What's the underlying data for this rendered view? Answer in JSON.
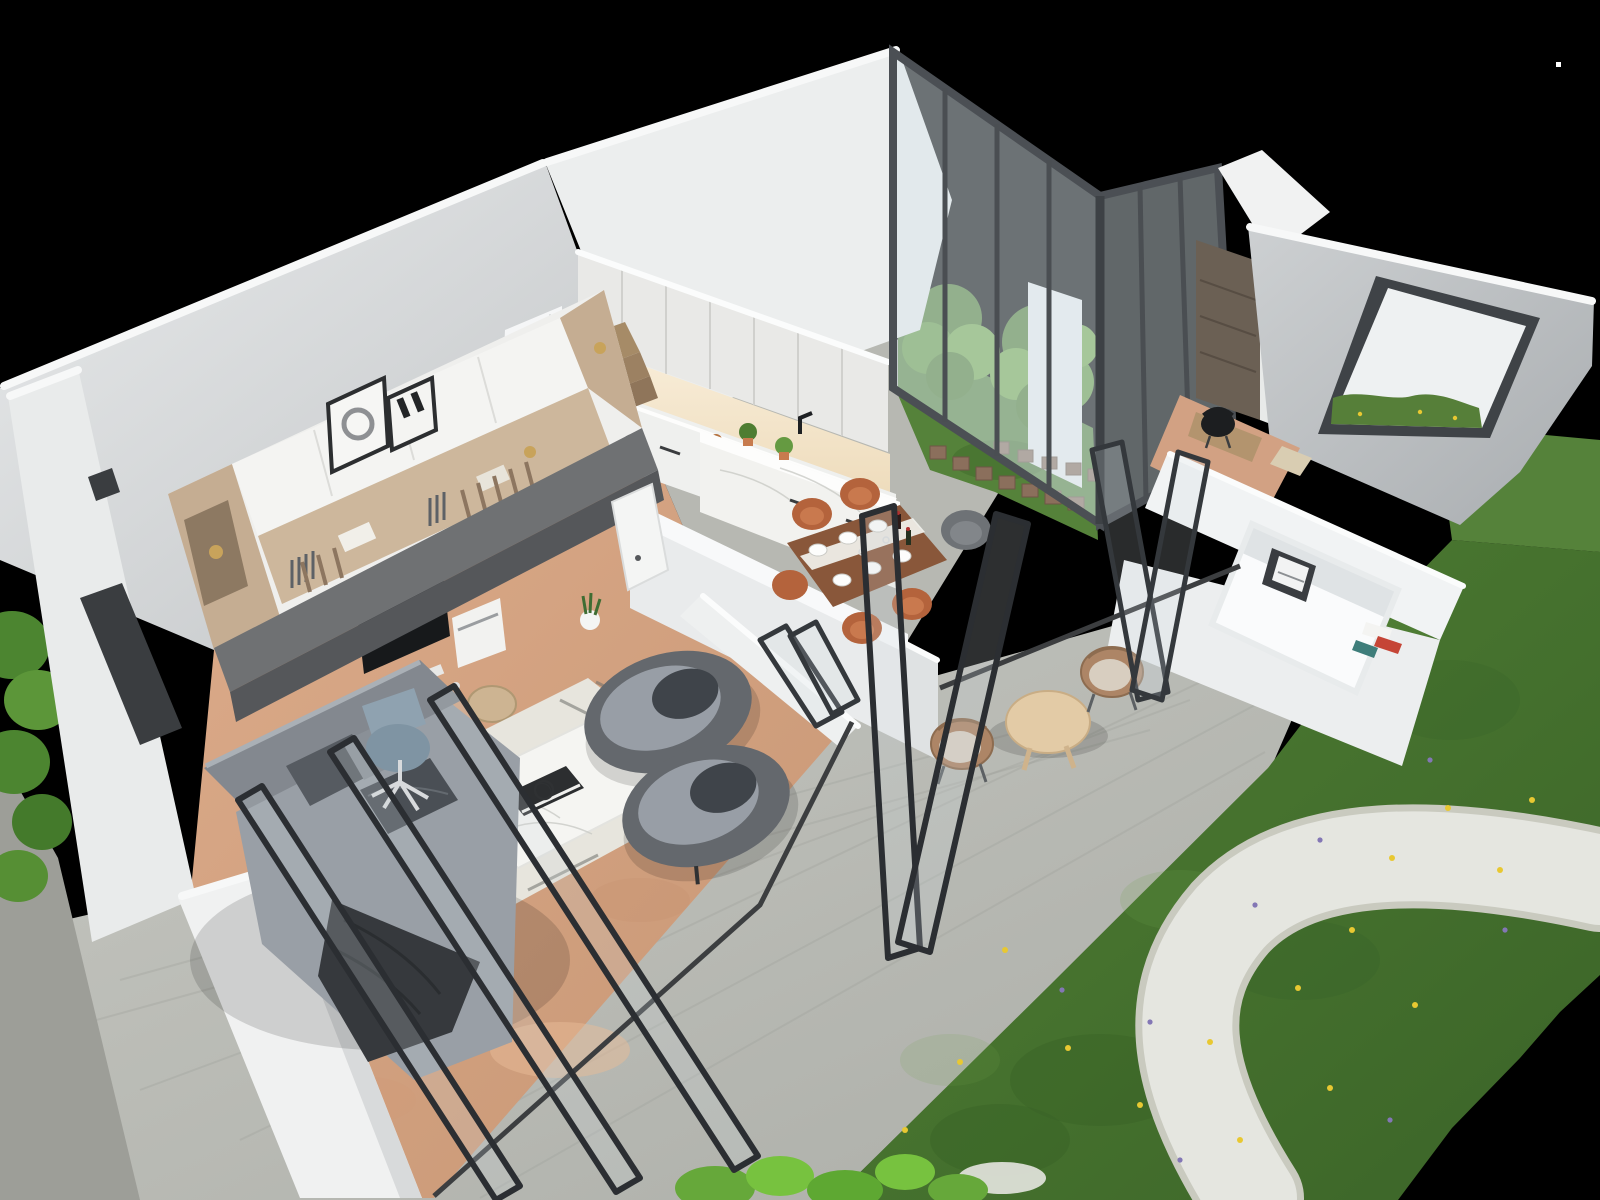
{
  "scene": {
    "type": "3d-architectural-cutaway-render",
    "view": "high-angle aerial dollhouse view, walls cut open, black backdrop",
    "description": "Modern single-storey home: open-plan living room with media wall and desk, grey sectional sofa, two tub armchairs and marble coffee table on cork floor; white kitchen with island; set dining table with terracotta chairs; internal glazed courtyard with trees and cube stools; study nook; bathroom with large white tub and picture window onto lawn; black bifold doors opening to a concrete patio with rope lounge chairs; garden with lawn, wildflowers and white gravel path."
  },
  "palette": {
    "bg_black": "#000000",
    "wall_white": "#eff1f1",
    "wall_light": "#e7e9ea",
    "wall_shade": "#c3c6c8",
    "wall_grey_right": "#bfc3c5",
    "rim_white": "#f7f8f8",
    "floor_cork": "#d7a685",
    "floor_concrete": "#bcbdb7",
    "kitchen_floor": "#b7b8b2",
    "grass_mid": "#4a7a31",
    "grass_dark": "#3a6226",
    "grass_light": "#639441",
    "courtyard_grass": "#55823a",
    "gravel": "#e5e6e0",
    "hedge_green": "#4c8530",
    "bush_green": "#66a83a",
    "tree_green": "#4e7d31",
    "tree_green_light": "#659a41",
    "glass_frame": "#4b4f54",
    "door_frame_black": "#2b2e32",
    "window_frame": "#3f4347",
    "sofa_grey": "#999fa6",
    "sofa_back": "#83888f",
    "pillow_dark": "#545a60",
    "throw_charcoal": "#36393d",
    "armchair_shell": "#64686d",
    "armchair_seat": "#989ea6",
    "cushion_charcoal": "#3f444a",
    "marble_white": "#f5f5f2",
    "rug_ivory": "#e7e5dd",
    "cabinet_white": "#e9e9e7",
    "counter_white": "#eff0ee",
    "backsplash_warm": "#f7ecd7",
    "island_marble": "#f2f2ef",
    "table_walnut": "#89573a",
    "chair_terracotta": "#b4633c",
    "chair_grey_tub": "#6e7276",
    "stair_wood": "#a68b67",
    "unit_oak": "#c5ad92",
    "desk_grey": "#6f7173",
    "gold_accent": "#c8a35b",
    "monitor_black": "#17191b",
    "office_chair_blue": "#7f94a3",
    "rope_chair_tan": "#ad8566",
    "outdoor_cushion": "#d8cec0",
    "outdoor_table_wood": "#e3cba6",
    "cube_stool_brown": "#8b6f5c",
    "tub_white": "#fafbfc",
    "bath_wall": "#f1f3f4",
    "study_floor": "#d2a183",
    "study_desk": "#b3946e",
    "chair_black": "#1c1e20",
    "wardrobe_brown": "#6b6054",
    "flower_yellow": "#e8c832",
    "flower_purple": "#8377b5",
    "artifact_dot": "#ffffff"
  },
  "rooms": [
    {
      "name": "living-room",
      "items": [
        "media-wall-unit",
        "desk",
        "office-chair",
        "sectional-sofa",
        "pillows",
        "throw-blanket",
        "tub-armchair x2",
        "marble-coffee-table",
        "decor-spheres",
        "book",
        "striped-rug",
        "wicker-pouf",
        "framed-art x2",
        "snake-plant"
      ]
    },
    {
      "name": "kitchen",
      "items": [
        "upper-cabinets",
        "backsplash-lit",
        "counter-run",
        "oven",
        "cooktop",
        "black-faucet",
        "copper-pot",
        "marble-island",
        "potted-herbs x2"
      ]
    },
    {
      "name": "dining-area",
      "items": [
        "walnut-table",
        "table-runner",
        "place-settings x6",
        "wine-bottles",
        "terracotta-chairs x5",
        "grey-tub-chair"
      ]
    },
    {
      "name": "staircase",
      "items": [
        "white-balustrade",
        "wood-treads"
      ]
    },
    {
      "name": "glazed-courtyard",
      "items": [
        "glass-walls-dark-frames",
        "trees x2",
        "lawn",
        "cube-stools x12",
        "white-pillar"
      ]
    },
    {
      "name": "study-nook",
      "items": [
        "wardrobe",
        "desk",
        "black-chair",
        "terracotta-floor"
      ]
    },
    {
      "name": "bathroom",
      "items": [
        "sunken-white-tub",
        "picture-frame",
        "magazines",
        "picture-window-to-lawn"
      ]
    },
    {
      "name": "patio",
      "items": [
        "concrete-paving",
        "bifold-doors-black x4 sets",
        "rope-armchairs x2",
        "round-timber-table"
      ]
    },
    {
      "name": "garden",
      "items": [
        "lawn",
        "yellow-wildflowers",
        "purple-wildflowers",
        "white-gravel-path",
        "bright-bushes",
        "side-hedge"
      ]
    }
  ],
  "artifact": {
    "white_dot": {
      "x": 1557,
      "y": 63
    }
  }
}
